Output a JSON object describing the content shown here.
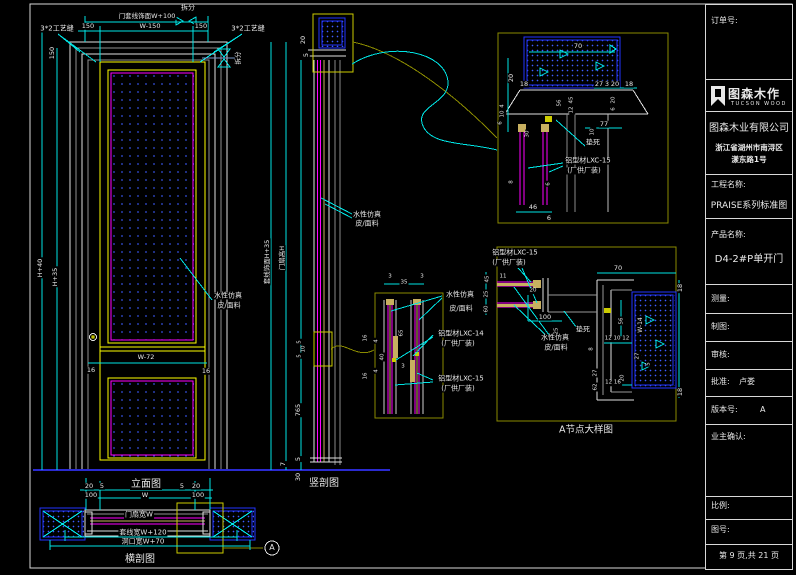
{
  "title_block": {
    "order_label": "订单号:",
    "logo": {
      "name": "图森木作",
      "sub": "TUCSON WOOD"
    },
    "company": "图森木业有限公司",
    "address1": "浙江省湖州市南浔区",
    "address2": "漾东路1号",
    "project_label": "工程名称:",
    "project_value": "PRAISE系列标准图",
    "product_label": "产品名称:",
    "product_value": "D4-2#P单开门",
    "measure_label": "测量:",
    "draft_label": "制图:",
    "audit_label": "审核:",
    "approve_label": "批准:",
    "approve_value": "卢娄",
    "version_label": "版本号:",
    "version_value": "A",
    "owner_label": "业主确认:",
    "scale_label": "比例:",
    "figno_label": "图号:",
    "page_info": "第 9 页,共 21 页"
  },
  "palette": {
    "background": "#000000",
    "line": "#e8e8e8",
    "dimension": "#00e5e5",
    "frame_accent": "#ffff00",
    "panel": "#ff00ff",
    "wall": "#2233ff",
    "detail_box": "#8a8a00",
    "wood": "#c8b060"
  },
  "annotations": {
    "elev_top_note": "门套线饰面W+100",
    "elev_dim_150_left": "150",
    "elev_dim_mid": "W-150",
    "elev_dim_150_right": "150",
    "label_chaifen": "拆分",
    "label_seam_left": "3*2工艺缝",
    "label_seam_right": "3*2工艺缝",
    "elev_dim_150_vert": "150",
    "elev_dim_h40": "H+40",
    "elev_dim_h35": "H+35",
    "split_sym_text": "拆分",
    "elev_dim_w72": "W-72",
    "elev_dim_16_left": "16",
    "elev_dim_16_right": "16",
    "cap_elevation": "立面图",
    "hs_dim_20_l": "20",
    "hs_dim_5_l": "5",
    "hs_dim_5_r": "5",
    "hs_dim_20_r": "20",
    "hs_dim_100_l": "100",
    "hs_dim_w": "W",
    "hs_dim_100_r": "100",
    "hs_leaf_w": "门扇宽W",
    "hs_trim_w": "套线宽W+120",
    "hs_hole_w": "洞口宽W+70",
    "cap_hsection": "横剖图",
    "marker_a": "A",
    "vs_dim_20": "20",
    "vs_dim_5": "5",
    "vs_trim_h": "套线饰面H+35",
    "vs_leaf_h": "门扇高H",
    "vs_dim_765": "765",
    "vs_dim_5b": "5",
    "vs_dim_7b": "7",
    "vs_dim_30b": "30",
    "vs_lock_5a": "5",
    "vs_lock_10": "10",
    "vs_lock_5b": "5",
    "cap_vsection": "竖剖图",
    "note_leather_mid1": "水性仿真",
    "note_leather_mid2": "皮/面料",
    "note_leather_door1": "水性仿真",
    "note_leather_door2": "皮/面料",
    "e_dim_70": "70",
    "e_dim_18l": "18",
    "e_dim_27": "27",
    "e_dim_3": "3",
    "e_dim_20": "20",
    "e_dim_18r": "18",
    "e_dim_20v": "20",
    "e_dim_4": "4",
    "e_dim_10": "10",
    "e_dim_6": "6",
    "e_dim_56": "56",
    "e_dim_45": "45",
    "e_dim_12": "12",
    "e_dim_20b": "20",
    "e_dim_6b": "6",
    "e_dim_77": "77",
    "e_dim_10b": "10",
    "e_dim_30": "30",
    "e_note_dead": "垫死",
    "e_alu15_1": "铝型材LXC-15",
    "e_alu15_2": "(厂供厂装)",
    "e_dim_8": "8",
    "e_dim_6c": "6",
    "e_dim_46": "46",
    "e_dim_6d": "6",
    "f_alu15_1": "铝型材LXC-15",
    "f_alu15_2": "(厂供厂装)",
    "f_dim_11": "11",
    "f_dim_20": "20",
    "f_dim_100": "100",
    "f_dim_25": "25",
    "f_dim_8": "8",
    "f_note_dead": "垫死",
    "f_leather1": "水性仿真",
    "f_leather2": "皮/面料",
    "f_dim_70": "70",
    "f_dim_18t": "18",
    "f_dim_w14": "W-14",
    "f_dim_18b": "18",
    "f_dim_56": "56",
    "f_dim_121012": "12 10 12",
    "f_dim_27": "27",
    "f_dim_5": "5",
    "f_dim_20v": "20",
    "f_dim_1216": "12 16",
    "f_dim_27b": "27",
    "f_dim_62": "62",
    "cap_adetail": "A节点大样图",
    "g_dim_3a": "3",
    "g_dim_35": "35",
    "g_dim_3b": "3",
    "g_dim_65": "65",
    "g_dim_16a": "16",
    "g_dim_4a": "4",
    "g_dim_40": "40",
    "g_dim_16b": "16",
    "g_dim_4b": "4",
    "g_dim_3c": "3",
    "g_leather1": "水性仿真",
    "g_leather2": "皮/面料",
    "g_alu14_1": "铝型材LXC-14",
    "g_alu14_2": "(厂供厂装)",
    "g_alu15_1": "铝型材LXC-15",
    "g_alu15_2": "(厂供厂装)",
    "g_dim_45": "45",
    "g_dim_25": "25",
    "g_dim_60": "60"
  }
}
